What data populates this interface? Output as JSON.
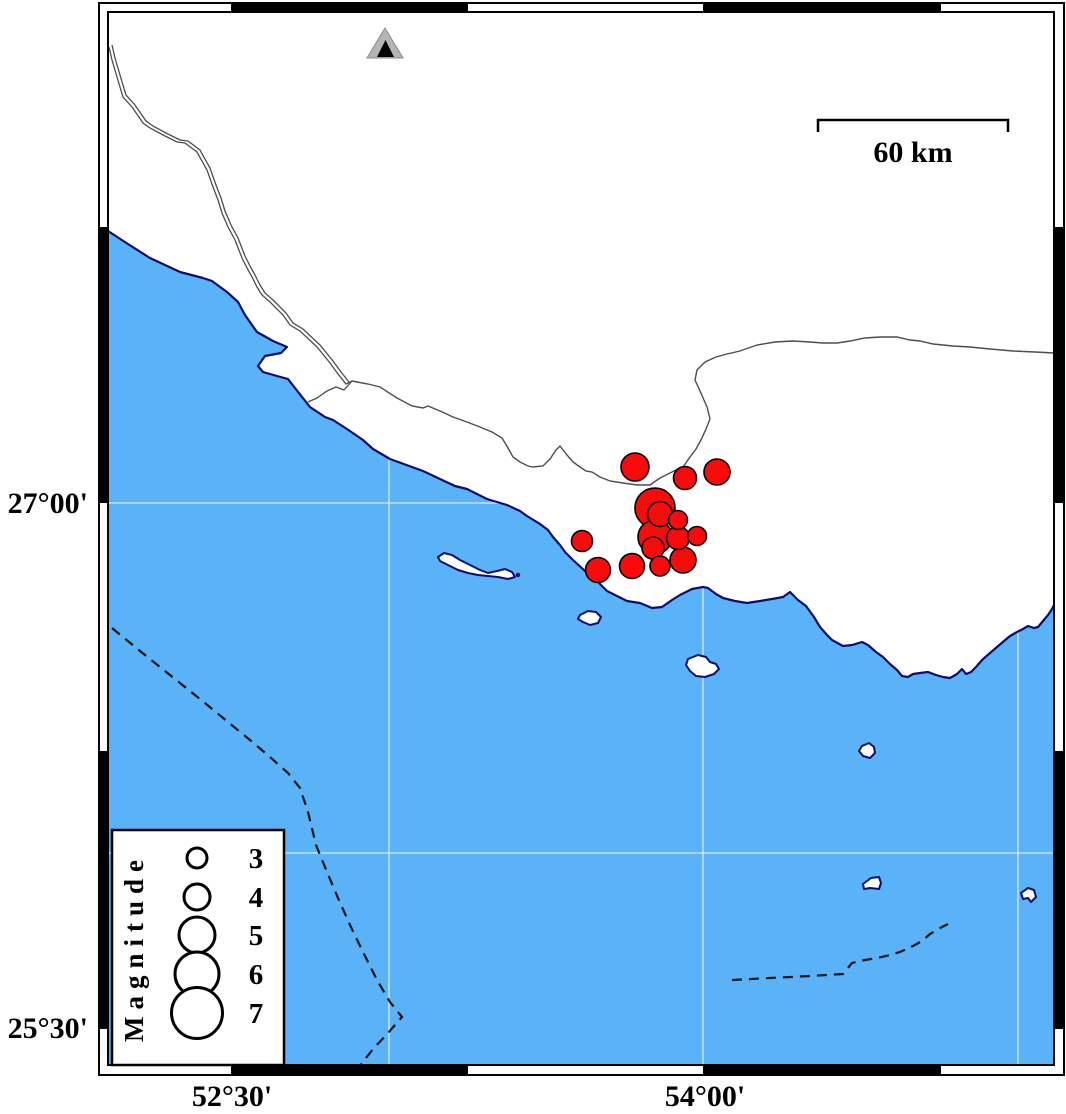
{
  "map_title": "seismicity-map",
  "colors": {
    "sea": "#5AB2F7",
    "land": "#FFFFFF",
    "coast": "#0D0D70",
    "grid": "rgba(255,255,255,0.75)",
    "boundary_line": "#4D4D4D",
    "dashed_line": "#141414",
    "quake_fill": "#FA0A0A",
    "quake_stroke": "#000000",
    "frame_black": "#000000",
    "station_outer": "#B5B5B5",
    "station_outer_edge": "#8A8A8A",
    "station_inner": "#000000"
  },
  "axes": {
    "left": [
      {
        "label": "27°00'",
        "y": 503
      },
      {
        "label": "25°30'",
        "y": 1028
      }
    ],
    "bottom": [
      {
        "label": "52°30'",
        "x": 232
      },
      {
        "label": "54°00'",
        "x": 705
      }
    ]
  },
  "scale_bar": {
    "label": "60 km",
    "x1": 818,
    "x2": 1008,
    "y": 120,
    "tick_drop": 12,
    "label_x": 913,
    "label_y": 162
  },
  "legend": {
    "title": "Magnitude",
    "box": {
      "x": 112,
      "y": 830,
      "w": 172,
      "h": 235
    },
    "circle_x": 197,
    "label_x": 256,
    "title_x": 143,
    "entries": [
      {
        "magnitude": "3",
        "r": 10,
        "y": 858
      },
      {
        "magnitude": "4",
        "r": 13,
        "y": 897
      },
      {
        "magnitude": "5",
        "r": 18,
        "y": 935
      },
      {
        "magnitude": "6",
        "r": 22,
        "y": 974
      },
      {
        "magnitude": "7",
        "r": 25.5,
        "y": 1013
      }
    ]
  },
  "station": {
    "outer": "385,28 367,58 403,58",
    "inner": "385.5,40 377,57 394,57"
  },
  "earthquakes": [
    {
      "cx": 635,
      "cy": 467,
      "r": 14
    },
    {
      "cx": 685,
      "cy": 478,
      "r": 11.5
    },
    {
      "cx": 717,
      "cy": 472,
      "r": 13
    },
    {
      "cx": 655,
      "cy": 508,
      "r": 20
    },
    {
      "cx": 660,
      "cy": 514,
      "r": 12.5
    },
    {
      "cx": 678,
      "cy": 520,
      "r": 9.5
    },
    {
      "cx": 655,
      "cy": 537,
      "r": 17
    },
    {
      "cx": 678,
      "cy": 538,
      "r": 11.5
    },
    {
      "cx": 697,
      "cy": 536,
      "r": 9.5
    },
    {
      "cx": 582,
      "cy": 541,
      "r": 10.5
    },
    {
      "cx": 653,
      "cy": 548,
      "r": 11
    },
    {
      "cx": 683,
      "cy": 560,
      "r": 13
    },
    {
      "cx": 660,
      "cy": 566,
      "r": 10
    },
    {
      "cx": 632,
      "cy": 566,
      "r": 12.5
    },
    {
      "cx": 598,
      "cy": 570,
      "r": 12.5
    }
  ],
  "frame": {
    "outer": {
      "x": 99,
      "y": 3,
      "w": 965,
      "h": 1072
    },
    "inner": {
      "x": 108,
      "y": 12,
      "w": 946,
      "h": 1053
    },
    "black_segments_horizontal": [
      [
        232,
        467
      ],
      [
        704,
        940
      ]
    ],
    "black_segments_vertical": [
      [
        228,
        502
      ],
      [
        752,
        1028
      ]
    ]
  },
  "gridlines": {
    "vertical_x": [
      389,
      703,
      1018
    ],
    "horizontal_y": [
      503,
      853
    ]
  },
  "geometry": {
    "coast_points": "108,231 128,244 150,258 180,272 203,278 212,281 227,292 238,302 245,315 252,325 257,332 273,341 287,347 281,353 265,356 258,366 263,372 277,376 288,379 295,388 310,407 325,417 333,420 347,429 363,440 373,449 390,459 423,471 440,479 455,486 467,489 487,499 507,505 520,511 527,516 540,524 548,530 553,537 560,545 565,552 573,560 585,571 597,581 607,591 617,596 627,601 640,603 652,608 662,607 672,600 680,595 692,589 703,587 708,588 716,594 723,598 735,601 747,603 760,601 772,599 783,597 790,592 794,596 798,600 806,606 814,617 820,627 827,635 832,640 843,646 852,645 862,642 868,645 876,652 883,657 890,664 897,670 902,676 908,677 913,674 920,673 928,672 936,675 943,677 950,678 957,674 962,669 966,674 971,672 976,667 982,660 990,653 997,647 1004,641 1010,636 1017,632 1023,629 1028,626 1034,628 1038,627 1043,621 1048,615 1052,609 1054,605",
    "boundary_main": "M 352,381 L 368,384 L 380,387 L 397,398 L 412,406 L 423,408 L 428,406 L 440,411 L 453,417 L 467,422 L 480,427 L 492,432 L 502,438 L 508,448 L 513,457 L 520,462 L 528,466 L 533,467 L 543,466 L 550,459 L 556,450 L 560,446 L 567,455 L 573,462 L 580,467 L 586,471 L 592,472 L 600,477 L 610,481 L 623,483 L 637,485 L 650,485 L 660,478 L 668,474 L 676,470 L 683,467 L 690,457 L 696,449 L 701,440 L 706,429 L 710,419 L 707,407 L 700,391 L 695,380 L 697,370 L 705,362 L 716,357 L 727,354 L 740,351 L 757,345 L 775,342 L 793,341 L 810,342 L 823,343 L 837,343 L 850,341 L 865,338 L 880,337 L 897,337 L 910,340 L 920,341 L 933,344 L 953,346 L 970,347 L 990,349 L 1013,351 L 1035,352 L 1054,353",
    "boundary_upper_a": "M 109,47 L 112,60 L 117,77 L 123,97 L 132,107 L 143,123 L 150,128 L 163,135 L 177,142 L 185,143 L 197,152 L 207,170 L 213,187 L 218,200 L 222,213 L 228,227 L 235,240 L 242,258 L 247,268 L 252,277 L 257,287 L 262,295 L 270,302 L 283,315 L 290,325 L 300,331 L 317,347 L 330,363 L 338,374 L 346,384 L 352,381",
    "boundary_upper_b": "M 112,45 L 115,58 L 120,75 L 126,95 L 135,105 L 146,121 L 153,126 L 166,133 L 180,140 L 188,141 L 200,150 L 210,168 L 216,185 L 221,198 L 225,211 L 231,225 L 238,238 L 245,256 L 250,266 L 255,275 L 260,285 L 265,293 L 273,300 L 286,313 L 293,323 L 303,329 L 320,345 L 333,361 L 341,372 L 349,382",
    "boundary_branch": "M 352,381 L 344,390 L 336,387 L 327,391 L 317,398 L 308,402",
    "dashed_left": "M 112,628 L 140,651 L 170,675 L 200,699 L 228,722 L 250,740 L 270,757 L 288,773 L 300,788 L 308,812 L 316,845 L 327,872 L 338,898 L 350,925 L 363,952 L 377,980 L 390,1002 L 402,1017 L 388,1033 L 374,1048 L 361,1064",
    "dashed_right": "M 732,980 L 770,978 L 810,976 L 843,974 L 852,963 L 865,960 L 877,958 L 890,955 L 900,952 L 913,946 L 922,941 L 930,934 L 940,928 L 948,924",
    "islands": [
      "M 438,557 L 444,553 L 452,555 L 460,560 L 470,565 L 480,570 L 488,573 L 497,571 L 505,569 L 512,572 L 515,577 L 508,579 L 498,577 L 488,576 L 478,575 L 468,573 L 458,570 L 448,565 L 440,561 Z",
      "M 580,615 L 588,611 L 596,612 L 601,617 L 598,623 L 590,625 L 583,622 L 578,619 Z",
      "M 688,659 L 698,655 L 706,657 L 710,662 L 716,664 L 719,669 L 714,674 L 705,677 L 696,676 L 690,671 L 686,665 Z",
      "M 862,746 L 869,743 L 874,747 L 875,753 L 870,758 L 863,756 L 859,751 Z",
      "M 863,884 L 871,878 L 879,877 L 881,883 L 879,889 L 870,888 L 864,889 Z",
      "M 1021,893 L 1028,888 L 1034,890 L 1036,897 L 1031,902 L 1028,898 L 1023,899 Z"
    ],
    "islet": {
      "cx": 518,
      "cy": 575,
      "r": 2.2
    }
  }
}
